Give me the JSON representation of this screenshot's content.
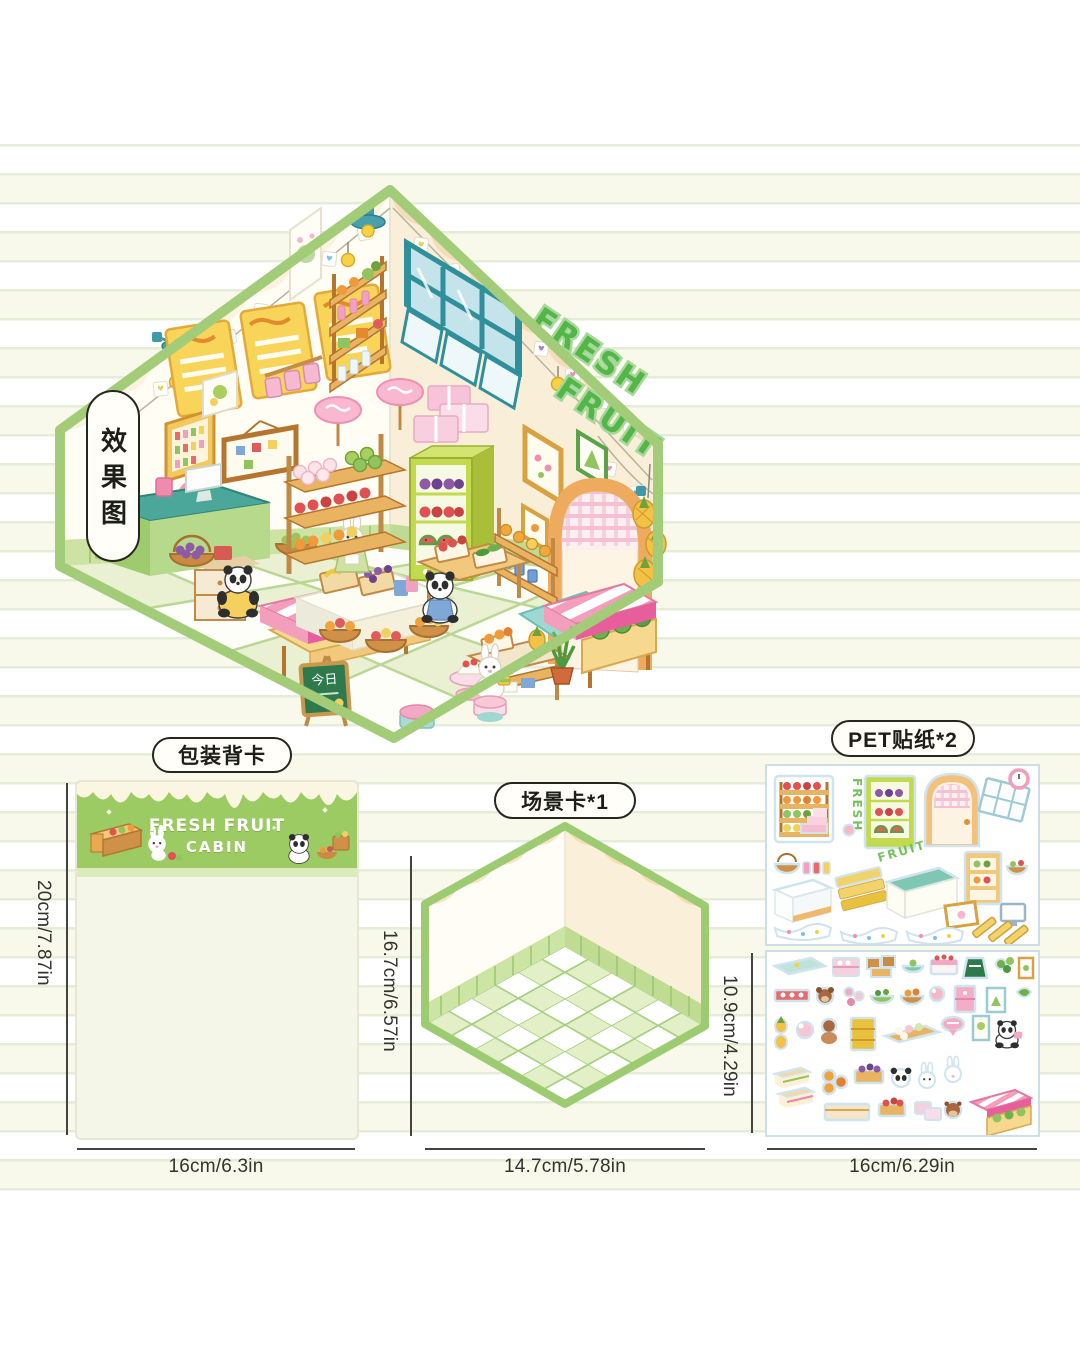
{
  "labels": {
    "render_preview": "效果图",
    "back_card": "包装背卡",
    "scene_card": "场景卡*1",
    "pet_stickers": "PET贴纸*2"
  },
  "room": {
    "sign_line1": "FRESH",
    "sign_line2": "FRUIT",
    "chalkboard": "今日"
  },
  "back_card": {
    "title_line1": "FRESH FRUIT",
    "title_line2": "CABIN",
    "height_label": "20cm/7.87in",
    "width_label": "16cm/6.3in"
  },
  "scene_card": {
    "height_label": "16.7cm/6.57in",
    "width_label": "14.7cm/5.78in"
  },
  "stickers": {
    "sheet1_word_fresh": "FRESH",
    "sheet1_word_fruit": "FRUIT",
    "sheet2_height_label": "10.9cm/4.29in",
    "width_label": "16cm/6.29in"
  },
  "colors": {
    "accent_green": "#9ccb72",
    "header_green": "#9bcb62",
    "awning_pink": "#e85d9b",
    "teal": "#3f9aa8",
    "wood": "#c08a46"
  }
}
